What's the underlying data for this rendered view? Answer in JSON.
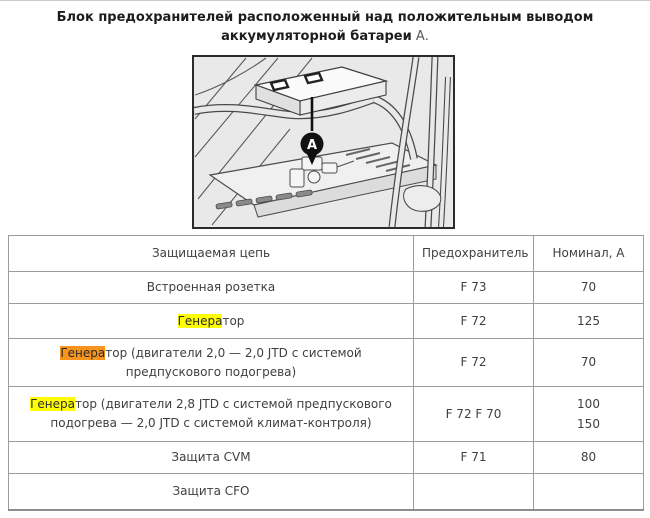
{
  "title": {
    "line1": "Блок предохранителей расположенный над положительным выводом",
    "line2_main": "аккумуляторной батареи",
    "line2_suffix": " А."
  },
  "figure": {
    "description": "line-drawing of battery with fuse block above positive terminal",
    "callout_label": "A"
  },
  "table": {
    "headers": {
      "circuit": "Защищаемая цепь",
      "fuse": "Предохранитель",
      "rating": "Номинал, А"
    },
    "rows": [
      {
        "pre": "Встроенная розетка",
        "match": "",
        "rest": "",
        "fuse": "F 73",
        "ratings": [
          "70"
        ]
      },
      {
        "pre": "",
        "match": "Генера",
        "highlight": "yellow",
        "rest": "тор",
        "fuse": "F 72",
        "ratings": [
          "125"
        ]
      },
      {
        "pre": "",
        "match": "Генера",
        "highlight": "orange",
        "rest": "тор (двигатели 2,0 — 2,0 JTD с системой предпускового подогрева)",
        "fuse": "F 72",
        "ratings": [
          "70"
        ]
      },
      {
        "pre": "",
        "match": "Генера",
        "highlight": "yellow",
        "rest": "тор (двигатели 2,8 JTD с системой предпускового подогрева — 2,0 JTD с системой климат-контроля)",
        "fuse": "F 72 F 70",
        "ratings": [
          "100",
          "150"
        ]
      },
      {
        "pre": "Защита CVM",
        "match": "",
        "rest": "",
        "fuse": "F 71",
        "ratings": [
          "80"
        ]
      },
      {
        "pre": "Защита CFO",
        "match": "",
        "rest": "",
        "fuse": "",
        "ratings": []
      }
    ]
  },
  "colors": {
    "highlight_yellow": "#ffff00",
    "highlight_orange": "#f7941e",
    "table_border": "#9c9c9c",
    "figure_border": "#2b2b2b",
    "text": "#3f3f3f"
  }
}
